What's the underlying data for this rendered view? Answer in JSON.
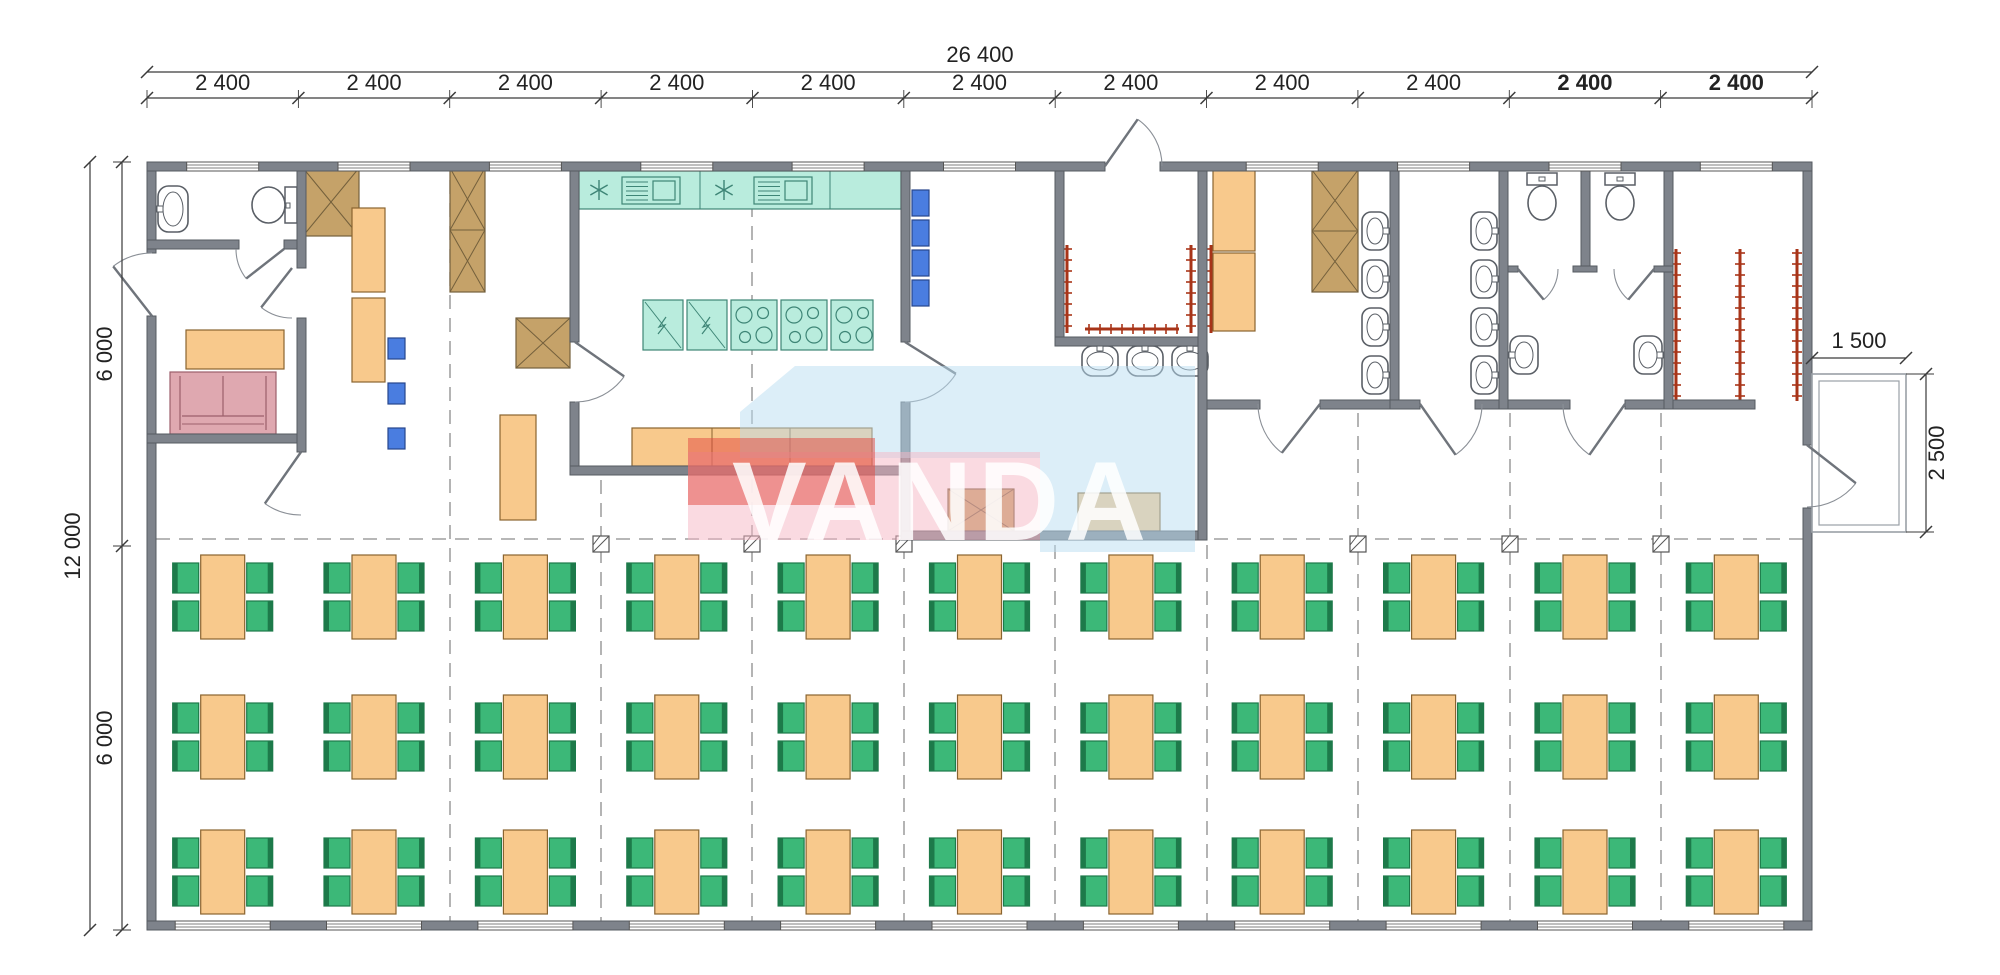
{
  "colors": {
    "wall": "#7e838b",
    "wall_edge": "#565b62",
    "orange": "#f8c98c",
    "orange_edge": "#8a6430",
    "teal": "#b9ecdd",
    "teal_edge": "#3e8576",
    "green": "#3cb878",
    "green_edge": "#1d7a4a",
    "blue": "#4a7de0",
    "blue_edge": "#27458c",
    "pink": "#dfa8b0",
    "pink_edge": "#9c5f6b",
    "brown": "#c5a269",
    "brown_edge": "#74603c",
    "red": "#a83418",
    "grid": "#8c8c8c",
    "dim": "#3a3a3a",
    "text": "#222222",
    "fixture": "#5a5f66",
    "wm_blue": "#b9ddf1",
    "wm_pink": "#f5b6c3",
    "wm_red": "#e2473f"
  },
  "dims": {
    "top_total": {
      "label": "26 400",
      "y": 72,
      "x1": 147,
      "x2": 1812,
      "lx": 980,
      "ly": 62
    },
    "top_chain": {
      "y": 98,
      "ly": 90,
      "points": [
        147,
        298.4,
        449.7,
        601.1,
        752.5,
        903.8,
        1055.2,
        1206.5,
        1357.9,
        1509.3,
        1660.6,
        1812
      ],
      "labels": [
        {
          "label": "2 400",
          "bold": false
        },
        {
          "label": "2 400",
          "bold": false
        },
        {
          "label": "2 400",
          "bold": false
        },
        {
          "label": "2 400",
          "bold": false
        },
        {
          "label": "2 400",
          "bold": false
        },
        {
          "label": "2 400",
          "bold": false
        },
        {
          "label": "2 400",
          "bold": false
        },
        {
          "label": "2 400",
          "bold": false
        },
        {
          "label": "2 400",
          "bold": false
        },
        {
          "label": "2 400",
          "bold": true
        },
        {
          "label": "2 400",
          "bold": true
        }
      ]
    },
    "left_total": {
      "label": "12 000",
      "x": 90,
      "y1": 162,
      "y2": 930,
      "lx": 80,
      "ly": 546
    },
    "left_chain": {
      "x": 122,
      "points": [
        162,
        546,
        930
      ],
      "labels": [
        {
          "label": "6 000",
          "ly": 354
        },
        {
          "label": "6 000",
          "ly": 738
        }
      ],
      "lx": 112
    },
    "right_width": {
      "label": "1 500",
      "y": 358,
      "x1": 1812,
      "x2": 1906,
      "lx": 1859,
      "ly": 348
    },
    "right_height": {
      "label": "2 500",
      "x": 1926,
      "y1": 374,
      "y2": 532,
      "lx": 1944,
      "ly": 453
    }
  },
  "watermark": {
    "text": "VANDA"
  },
  "plan": {
    "porch": {
      "x": 1812,
      "y": 374,
      "w": 94,
      "h": 158
    },
    "walls": [
      [
        147,
        162,
        958,
        9
      ],
      [
        1160,
        162,
        652,
        9
      ],
      [
        147,
        921,
        1665,
        9
      ],
      [
        147,
        171,
        9,
        82
      ],
      [
        147,
        316,
        9,
        605
      ],
      [
        1803,
        171,
        9,
        274
      ],
      [
        1803,
        508,
        9,
        413
      ],
      [
        147,
        240,
        92,
        9
      ],
      [
        284,
        240,
        22,
        9
      ],
      [
        147,
        434,
        159,
        9
      ],
      [
        297,
        171,
        9,
        97
      ],
      [
        297,
        318,
        9,
        134
      ],
      [
        570,
        171,
        9,
        171
      ],
      [
        570,
        402,
        9,
        73
      ],
      [
        570,
        466,
        340,
        9
      ],
      [
        901,
        171,
        9,
        171
      ],
      [
        901,
        402,
        9,
        138
      ],
      [
        901,
        531,
        306,
        9
      ],
      [
        1055,
        171,
        9,
        166
      ],
      [
        1055,
        337,
        152,
        9
      ],
      [
        1198,
        171,
        9,
        369
      ],
      [
        1207,
        400,
        53,
        9
      ],
      [
        1320,
        400,
        70,
        9
      ],
      [
        1390,
        171,
        9,
        238
      ],
      [
        1390,
        400,
        30,
        9
      ],
      [
        1475,
        400,
        95,
        9
      ],
      [
        1499,
        171,
        9,
        238
      ],
      [
        1581,
        171,
        9,
        100
      ],
      [
        1625,
        400,
        130,
        9
      ],
      [
        1664,
        171,
        9,
        238
      ],
      [
        1508,
        266,
        10,
        6
      ],
      [
        1573,
        266,
        24,
        6
      ],
      [
        1654,
        266,
        19,
        6
      ]
    ],
    "windows": {
      "top": {
        "w": 72,
        "y": 162,
        "centers": [
          222.7,
          374,
          525.4,
          676.8,
          828.1,
          979.5,
          1282.2,
          1433.6,
          1585,
          1736.3
        ]
      },
      "bottom": {
        "w": 95,
        "y": 921,
        "centers": [
          222.7,
          374,
          525.4,
          676.8,
          828.1,
          979.5,
          1130.9,
          1282.2,
          1433.6,
          1585,
          1736.3
        ]
      }
    },
    "doors": [
      {
        "hx": 152,
        "hy": 316,
        "r": 63,
        "af": -90,
        "al": -128
      },
      {
        "hx": 284,
        "hy": 249,
        "r": 48,
        "af": 180,
        "al": 142
      },
      {
        "hx": 292,
        "hy": 268,
        "r": 50,
        "af": 90,
        "al": 128
      },
      {
        "hx": 301,
        "hy": 452,
        "r": 63,
        "af": 90,
        "al": 125
      },
      {
        "hx": 575,
        "hy": 342,
        "r": 60,
        "af": 90,
        "al": 35
      },
      {
        "hx": 905,
        "hy": 342,
        "r": 60,
        "af": 90,
        "al": 32
      },
      {
        "hx": 1105,
        "hy": 166,
        "r": 57,
        "af": 0,
        "al": -55
      },
      {
        "hx": 1320,
        "hy": 404,
        "r": 62,
        "af": 180,
        "al": 128
      },
      {
        "hx": 1420,
        "hy": 404,
        "r": 62,
        "af": 0,
        "al": 55
      },
      {
        "hx": 1625,
        "hy": 404,
        "r": 62,
        "af": 180,
        "al": 125
      },
      {
        "hx": 1807,
        "hy": 445,
        "r": 62,
        "af": 90,
        "al": 38
      },
      {
        "hx": 1518,
        "hy": 269,
        "r": 40,
        "af": 0,
        "al": 50
      },
      {
        "hx": 1654,
        "hy": 269,
        "r": 40,
        "af": 180,
        "al": 130
      }
    ],
    "grid": {
      "v": [
        {
          "x": 450,
          "y1": 180,
          "y2": 921
        },
        {
          "x": 601,
          "y1": 480,
          "y2": 921
        },
        {
          "x": 752,
          "y1": 180,
          "y2": 921
        },
        {
          "x": 904,
          "y1": 545,
          "y2": 921
        },
        {
          "x": 1055,
          "y1": 545,
          "y2": 921
        },
        {
          "x": 1207,
          "y1": 545,
          "y2": 921
        },
        {
          "x": 1358,
          "y1": 413,
          "y2": 921
        },
        {
          "x": 1510,
          "y1": 413,
          "y2": 921
        },
        {
          "x": 1661,
          "y1": 413,
          "y2": 921
        }
      ],
      "h": {
        "y": 539,
        "x1": 156,
        "x2": 1803
      },
      "markers": [
        601,
        752,
        904,
        1358,
        1510,
        1661
      ],
      "marker_y": 544
    },
    "furniture": [
      {
        "t": "basin",
        "x": 158,
        "y": 186,
        "w": 30,
        "h": 46,
        "o": "left"
      },
      {
        "t": "toilet",
        "x": 250,
        "y": 184,
        "w": 47,
        "h": 42,
        "o": "right"
      },
      {
        "t": "table",
        "x": 186,
        "y": 330,
        "w": 98,
        "h": 39
      },
      {
        "t": "sofa",
        "x": 170,
        "y": 372,
        "w": 106,
        "h": 62
      },
      {
        "t": "wardrobe",
        "x": 303,
        "y": 168,
        "w": 56,
        "h": 68
      },
      {
        "t": "wardrobe2",
        "x": 450,
        "y": 168,
        "w": 35,
        "h": 124
      },
      {
        "t": "desk",
        "x": 352,
        "y": 208,
        "w": 33,
        "h": 84
      },
      {
        "t": "desk",
        "x": 352,
        "y": 298,
        "w": 33,
        "h": 84
      },
      {
        "t": "chair_blue",
        "x": 388,
        "y": 338,
        "w": 17,
        "h": 21
      },
      {
        "t": "chair_blue",
        "x": 388,
        "y": 383,
        "w": 17,
        "h": 21
      },
      {
        "t": "chair_blue",
        "x": 388,
        "y": 428,
        "w": 17,
        "h": 21
      },
      {
        "t": "wardrobe",
        "x": 516,
        "y": 318,
        "w": 54,
        "h": 50
      },
      {
        "t": "desk",
        "x": 500,
        "y": 415,
        "w": 36,
        "h": 105
      },
      {
        "t": "counter_sink",
        "x": 579,
        "y": 171,
        "w": 322,
        "h": 38
      },
      {
        "t": "fridge",
        "x": 643,
        "y": 300,
        "w": 40,
        "h": 50
      },
      {
        "t": "fridge",
        "x": 687,
        "y": 300,
        "w": 40,
        "h": 50
      },
      {
        "t": "cooktop",
        "x": 731,
        "y": 300,
        "w": 46,
        "h": 50
      },
      {
        "t": "cooktop",
        "x": 781,
        "y": 300,
        "w": 46,
        "h": 50
      },
      {
        "t": "cooktop",
        "x": 831,
        "y": 300,
        "w": 42,
        "h": 50
      },
      {
        "t": "counter",
        "x": 632,
        "y": 428,
        "w": 240,
        "h": 38
      },
      {
        "t": "shelf_blue",
        "x": 912,
        "y": 190,
        "w": 17,
        "h": 26
      },
      {
        "t": "shelf_blue",
        "x": 912,
        "y": 220,
        "w": 17,
        "h": 26
      },
      {
        "t": "shelf_blue",
        "x": 912,
        "y": 250,
        "w": 17,
        "h": 26
      },
      {
        "t": "shelf_blue",
        "x": 912,
        "y": 280,
        "w": 17,
        "h": 26
      },
      {
        "t": "wardrobeH",
        "x": 948,
        "y": 489,
        "w": 66,
        "h": 42
      },
      {
        "t": "table_s",
        "x": 1078,
        "y": 493,
        "w": 82,
        "h": 38
      },
      {
        "t": "basin",
        "x": 1082,
        "y": 346,
        "w": 36,
        "h": 30,
        "o": "up"
      },
      {
        "t": "basin",
        "x": 1127,
        "y": 346,
        "w": 36,
        "h": 30,
        "o": "up"
      },
      {
        "t": "basin",
        "x": 1172,
        "y": 346,
        "w": 36,
        "h": 30,
        "o": "up"
      },
      {
        "t": "hooks_v",
        "x": 1067,
        "y": 245,
        "len": 88
      },
      {
        "t": "hooks_v",
        "x": 1191,
        "y": 245,
        "len": 88
      },
      {
        "t": "hooks_h",
        "x": 1085,
        "y": 329,
        "len": 94
      },
      {
        "t": "hooks_v",
        "x": 1211,
        "y": 245,
        "len": 88
      },
      {
        "t": "locker",
        "x": 1213,
        "y": 170,
        "w": 42,
        "h": 81
      },
      {
        "t": "locker",
        "x": 1213,
        "y": 253,
        "w": 42,
        "h": 78
      },
      {
        "t": "wardrobe2",
        "x": 1312,
        "y": 170,
        "w": 46,
        "h": 122
      },
      {
        "t": "basin",
        "x": 1362,
        "y": 212,
        "w": 26,
        "h": 38,
        "o": "right"
      },
      {
        "t": "basin",
        "x": 1362,
        "y": 260,
        "w": 26,
        "h": 38,
        "o": "right"
      },
      {
        "t": "basin",
        "x": 1362,
        "y": 308,
        "w": 26,
        "h": 38,
        "o": "right"
      },
      {
        "t": "basin",
        "x": 1362,
        "y": 356,
        "w": 26,
        "h": 38,
        "o": "right"
      },
      {
        "t": "basin",
        "x": 1471,
        "y": 212,
        "w": 26,
        "h": 38,
        "o": "right"
      },
      {
        "t": "basin",
        "x": 1471,
        "y": 260,
        "w": 26,
        "h": 38,
        "o": "right"
      },
      {
        "t": "basin",
        "x": 1471,
        "y": 308,
        "w": 26,
        "h": 38,
        "o": "right"
      },
      {
        "t": "basin",
        "x": 1471,
        "y": 356,
        "w": 26,
        "h": 38,
        "o": "right"
      },
      {
        "t": "toilet",
        "x": 1524,
        "y": 173,
        "w": 36,
        "h": 50,
        "o": "up"
      },
      {
        "t": "toilet",
        "x": 1602,
        "y": 173,
        "w": 36,
        "h": 50,
        "o": "up"
      },
      {
        "t": "basin",
        "x": 1510,
        "y": 336,
        "w": 28,
        "h": 38,
        "o": "left"
      },
      {
        "t": "basin",
        "x": 1634,
        "y": 336,
        "w": 28,
        "h": 38,
        "o": "right"
      },
      {
        "t": "rack_v",
        "x": 1676,
        "y": 249,
        "len": 152
      },
      {
        "t": "rack_v",
        "x": 1740,
        "y": 249,
        "len": 152
      },
      {
        "t": "rack_v",
        "x": 1797,
        "y": 249,
        "len": 152
      }
    ],
    "dining": {
      "cols": [
        222.7,
        374,
        525.4,
        676.8,
        828.1,
        979.5,
        1130.9,
        1282.2,
        1433.6,
        1585,
        1736.3
      ],
      "rows": [
        555,
        695,
        830
      ],
      "table": {
        "w": 44,
        "h": 84
      },
      "chair": {
        "w": 26,
        "h": 30
      }
    }
  }
}
